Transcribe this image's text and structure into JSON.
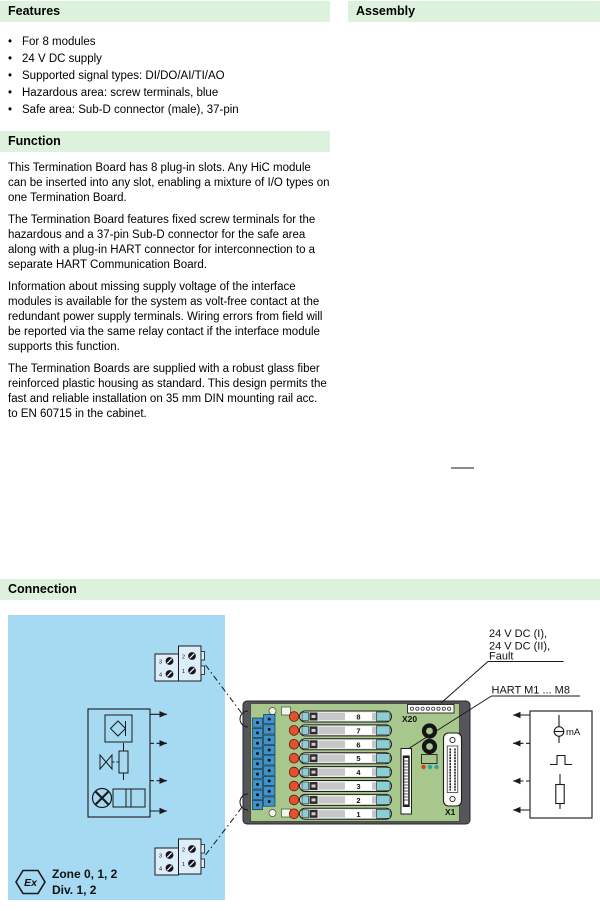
{
  "features": {
    "title": "Features",
    "items": [
      "For 8 modules",
      "24 V DC supply",
      "Supported signal types: DI/DO/AI/TI/AO",
      "Hazardous area: screw terminals, blue",
      "Safe area: Sub-D connector (male), 37-pin"
    ]
  },
  "assembly": {
    "title": "Assembly"
  },
  "function": {
    "title": "Function",
    "paragraphs": [
      "This Termination Board has 8 plug-in slots. Any HiC module can be inserted into any slot, enabling a mixture of I/O types on one Termination Board.",
      "The Termination Board features fixed screw terminals for the hazardous and a 37-pin Sub-D connector for the safe area along with a plug-in HART connector for interconnection to a separate HART Communication Board.",
      "Information about missing supply voltage of the interface modules is available for the system as volt-free contact at the redundant power supply terminals. Wiring errors from field will be reported via the same relay contact if the interface module supports this function.",
      "The Termination Boards are supplied with a robust glass fiber reinforced plastic housing as standard. This design permits the fast and reliable installation on 35 mm DIN mounting rail acc. to EN 60715 in the cabinet."
    ]
  },
  "connection": {
    "title": "Connection",
    "labels": {
      "power_line1": "24 V DC (I),",
      "power_line2": "24 V DC (II),",
      "power_line3": "Fault",
      "hart": "HART M1 ... M8",
      "x20": "X20",
      "x1": "X1",
      "zone": "Zone 0, 1, 2",
      "division": "Div. 1, 2",
      "ex": "Ex",
      "milliamp": "mA"
    },
    "modules": [
      "8",
      "7",
      "6",
      "5",
      "4",
      "3",
      "2",
      "1"
    ],
    "terminals": {
      "left_top": "3",
      "left_bottom": "4",
      "right_top": "2",
      "right_bottom": "1"
    },
    "colors": {
      "section_header_bg": "#ddf2dd",
      "hazardous_bg": "#a6d9f2",
      "board_green": "#a8c78d",
      "module_cap_teal": "#8ccfd3",
      "led_red": "#e2512e",
      "led_teal": "#2fa39f",
      "terminal_blue": "#3e93cc"
    }
  }
}
